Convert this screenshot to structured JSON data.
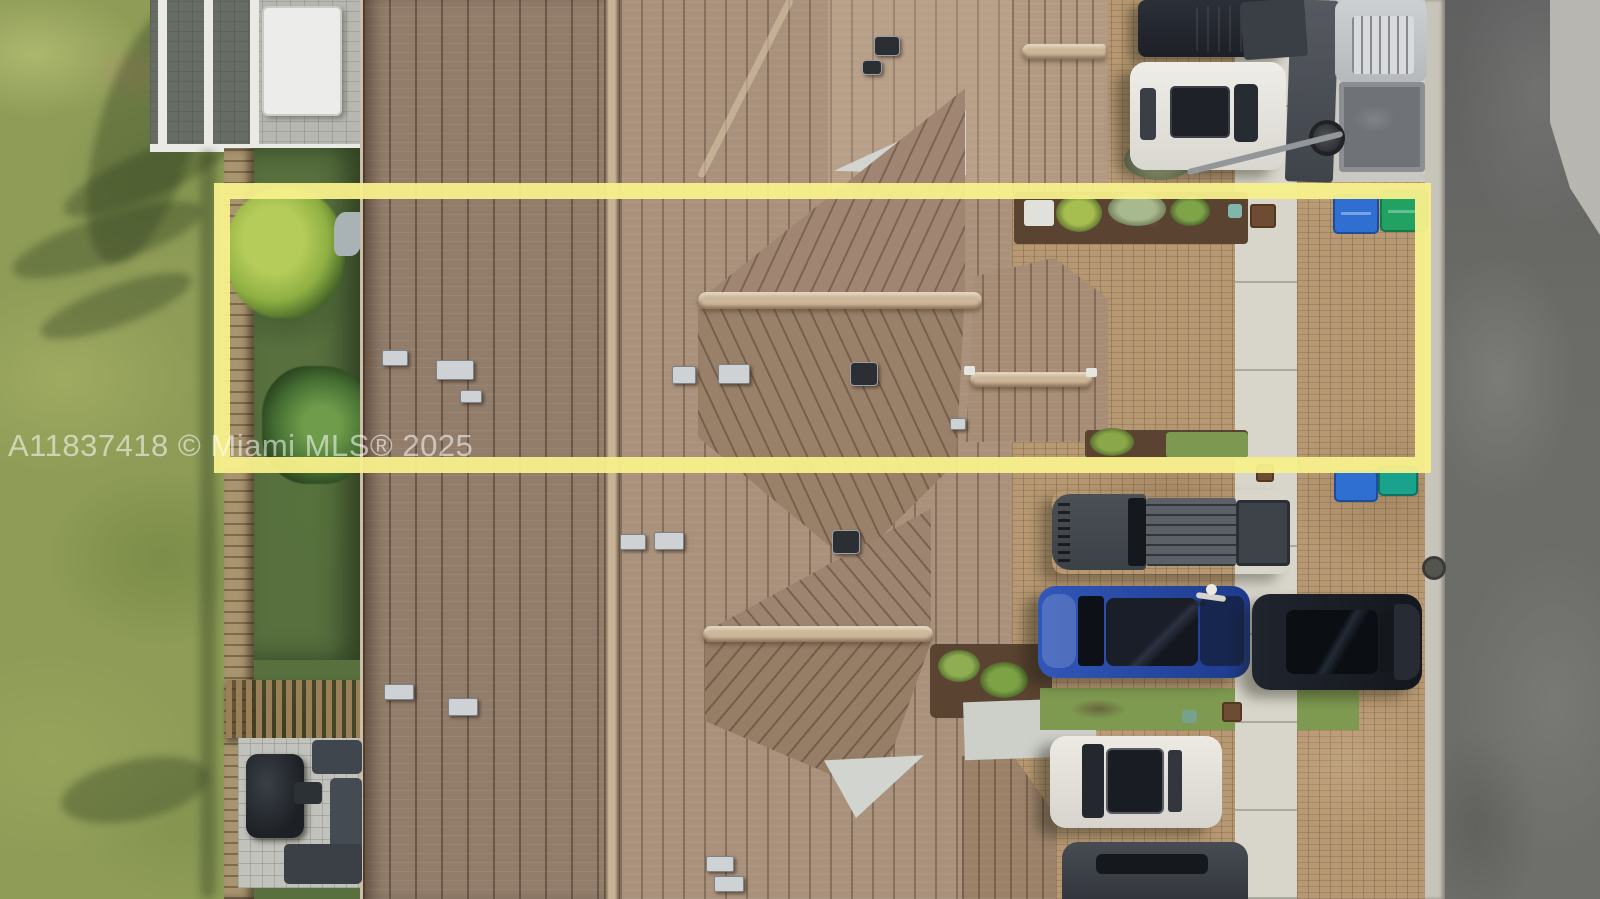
{
  "watermark": {
    "text": "A11837418 © Miami MLS® 2025",
    "color": "#FFFFFF",
    "opacity": 0.55
  },
  "highlight_box": {
    "color": "#F8F08C",
    "opacity": 0.95,
    "x": 214,
    "y": 183,
    "width": 1217,
    "height": 290,
    "border_px": 16
  },
  "scene": {
    "type": "aerial-drone-photo-of-townhouse-row",
    "palette": {
      "lawn": "#8E9C57",
      "backyard_grass": "#57703E",
      "roof_dark_plane": "#927D6B",
      "roof_light_plane": "#A9917B",
      "ridge_cap": "#CCB79A",
      "pavers": "#B69872",
      "sidewalk": "#D8D5CA",
      "road": "#6B6B67",
      "curb": "#C7C4B9",
      "mulch": "#5A4330",
      "highlight_yellow": "#F8F08C"
    },
    "vehicles": [
      "black-pickup-top",
      "white-suv-top",
      "silver-pickup-with-trailer",
      "gray-pickup-middle",
      "blue-suv",
      "dark-blue-car",
      "white-sedan",
      "dark-suv-bottom"
    ],
    "bins": [
      "blue-bin-top",
      "green-bin-top",
      "blue-bin-bottom",
      "teal-bin-bottom"
    ]
  }
}
